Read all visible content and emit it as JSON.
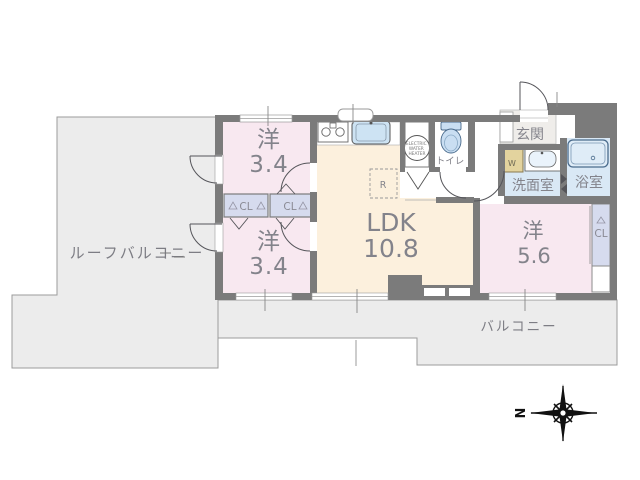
{
  "rooms": {
    "roof_balcony": {
      "label": "ルーフバルコニー"
    },
    "balcony": {
      "label": "バルコニー"
    },
    "bedroom_top": {
      "label": "洋",
      "area": "3.4"
    },
    "bedroom_bottom": {
      "label": "洋",
      "area": "3.4"
    },
    "bedroom_right": {
      "label": "洋",
      "area": "5.6"
    },
    "ldk": {
      "label": "LDK",
      "area": "10.8"
    },
    "entrance": {
      "label": "玄関"
    },
    "washroom": {
      "label": "洗面室"
    },
    "bathroom": {
      "label": "浴室"
    },
    "toilet": {
      "label": "トイレ"
    }
  },
  "closets": {
    "hall_left": "CL",
    "hall_right": "CL",
    "bedroom_right": "CL"
  },
  "appliances": {
    "refrigerator": "R",
    "washer": "W",
    "water_heater_lines": [
      "ELECTRIC",
      "WATER",
      "HEATER"
    ]
  },
  "compass": {
    "north": "N"
  },
  "colors": {
    "wall": "#7b7b7b",
    "balcony_fill": "#ececec",
    "balcony_stroke": "#9b9b9b",
    "bedroom_pink": "#f8e8f0",
    "ldk_cream": "#fcf0dd",
    "wet_blue": "#d9e8f5",
    "closet_lavender": "#d6dbee",
    "entrance_floor": "#efedea",
    "fixture_blue": "#c9def2",
    "washer_tan": "#e3d39e",
    "label_gray": "#83838b"
  }
}
